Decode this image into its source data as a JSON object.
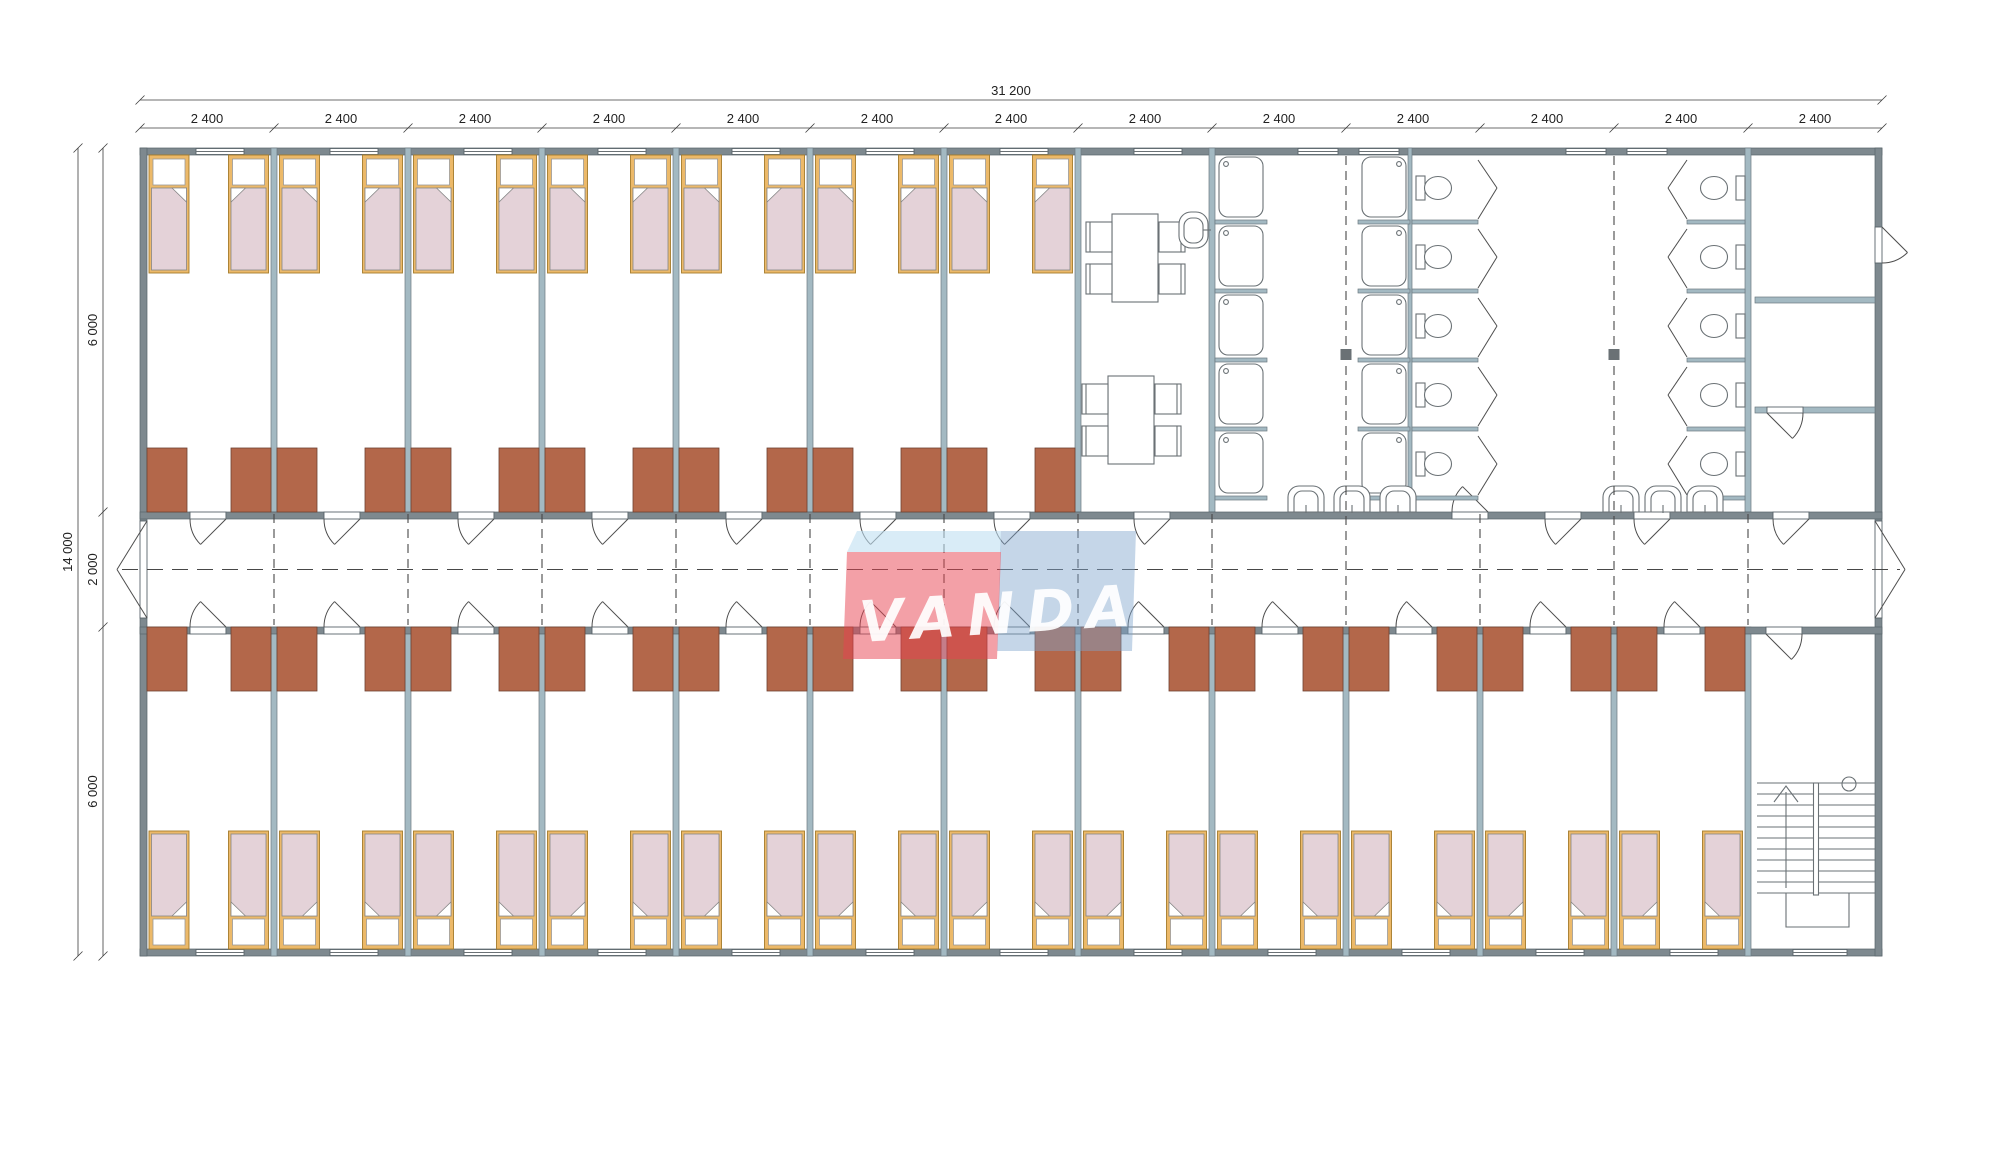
{
  "watermark": {
    "text": "VANDA"
  },
  "dimensions": {
    "total_width_label": "31 200",
    "module_width_label": "2 400",
    "module_count": 13,
    "total_height_label": "14 000",
    "height_segment_labels": [
      "6 000",
      "2 000",
      "6 000"
    ]
  },
  "layout_counts": {
    "top_bedrooms": 7,
    "bottom_bedrooms": 12,
    "beds_per_room": 2,
    "total_beds": 38,
    "wardrobes_top": 14,
    "wardrobes_bottom": 24,
    "dining_tables": 2,
    "chairs_per_table": 4,
    "shower_columns": 2,
    "showers_per_column": 5,
    "toilet_groups": 2,
    "toilets_per_group": 5,
    "washbasin_groups": 2,
    "washbasins_per_group": 3,
    "dining_washbasins": 1,
    "corridor_double_doors": 2,
    "stair_flights": 1
  },
  "colors": {
    "wall": "#7E898F",
    "partition": "#A3B9C2",
    "wardrobe": "#B3674A",
    "bed_frame": "#ECB969",
    "bed_blanket": "#E4D2D8",
    "fixture_outline": "#6A7175",
    "dimension_text": "#222222",
    "watermark_red": "#E84150",
    "watermark_blue": "#7FA3CC",
    "watermark_light_blue": "#BFE0F2"
  }
}
